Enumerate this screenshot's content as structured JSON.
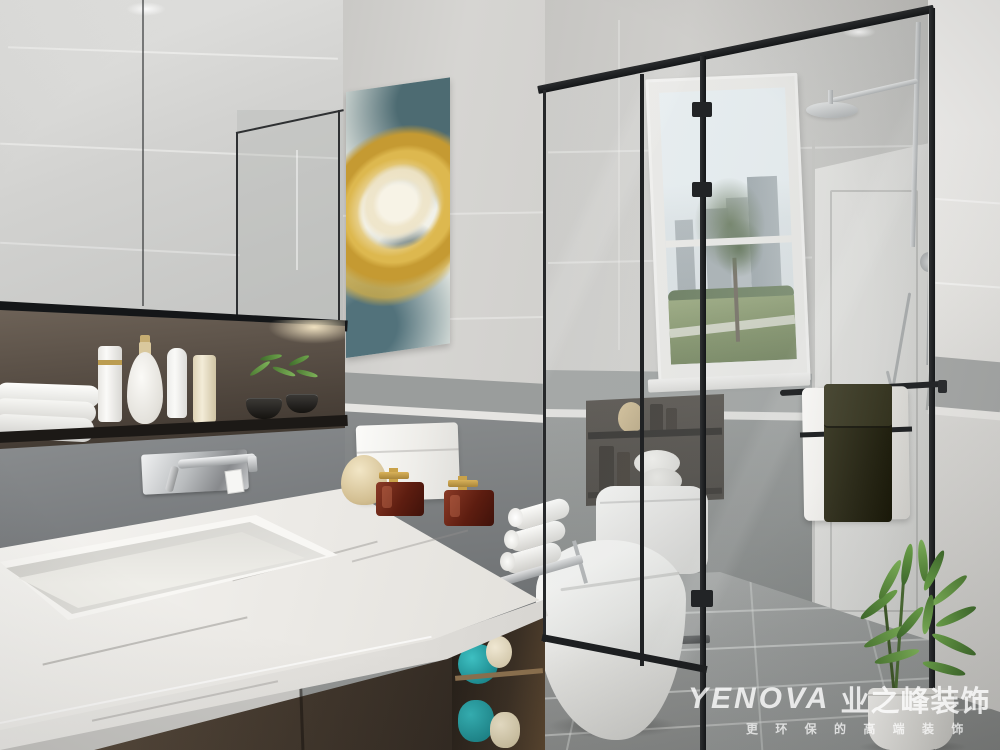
{
  "image": {
    "type": "3d-interior-render",
    "room": "bathroom",
    "style": "modern-gray",
    "width_px": 1000,
    "height_px": 750
  },
  "watermark": {
    "brand_latin": "YENOVA",
    "brand_cn": "业之峰装饰",
    "tagline": "更 环 保 的 高 端 装 饰",
    "text_color": "#ffffff"
  },
  "palette": {
    "wall_tile_light": "#cfcecb",
    "wall_band_gray": "#9a9d9c",
    "wall_lower_dark": "#7b7e7d",
    "niche_brown": "#5d5349",
    "marble_counter": "#f2f1ee",
    "vanity_wood": "#453a2f",
    "glass_frame_black": "#1c1e20",
    "floor_tile": "#9a9c9b",
    "towel_teal": "#21a0a4",
    "towel_dark_green": "#2b2a19",
    "art_gold": "#c59a32",
    "art_teal": "#4d6b72",
    "plant_green": "#5d8f3f",
    "chrome": "#a9acae"
  },
  "scene": {
    "objects": [
      "mirror-cabinet",
      "recessed-shelf-niche",
      "toiletry-bottles",
      "folded-white-towels",
      "abstract-gold-teal-wall-art",
      "cove-light",
      "wall-mounted-faucet",
      "marble-countertop",
      "integrated-sink",
      "amber-perfume-bottles",
      "white-storage-canister",
      "cream-vase",
      "rolled-towels-on-chrome-stand",
      "dark-wood-vanity-cabinet",
      "teal-towels-open-shelf",
      "black-framed-glass-shower-enclosure",
      "window-with-city-park-view",
      "rain-shower-head",
      "handheld-shower",
      "toilet",
      "niche-shelves-behind-toilet",
      "white-interior-door",
      "black-towel-bar",
      "white-hanging-towel",
      "dark-green-hanging-towel",
      "potted-green-plant",
      "gray-tile-floor"
    ]
  }
}
